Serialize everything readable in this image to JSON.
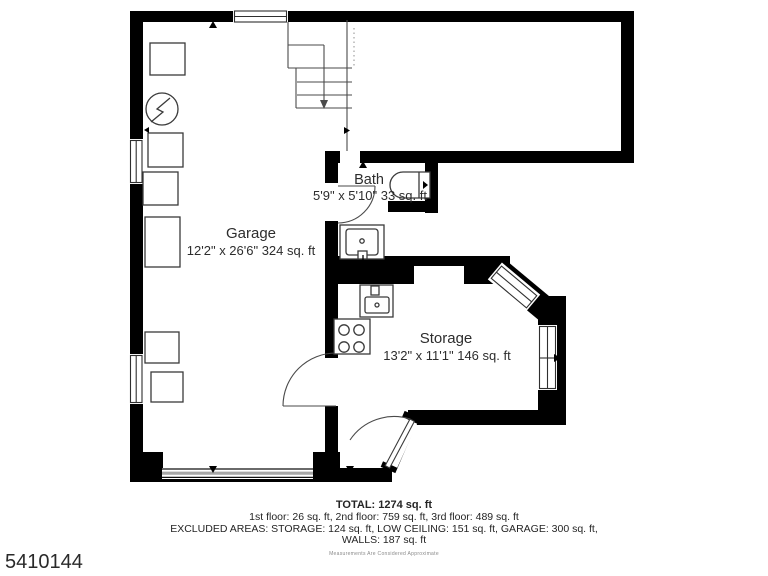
{
  "listing_id": "5410144",
  "rooms": {
    "garage": {
      "name": "Garage",
      "dims": "12'2\" x 26'6\" 324 sq. ft"
    },
    "bath": {
      "name": "Bath",
      "dims": "5'9\" x 5'10\" 33 sq. ft"
    },
    "storage": {
      "name": "Storage",
      "dims": "13'2\" x 11'1\" 146 sq. ft"
    }
  },
  "summary": {
    "total": "TOTAL: 1274 sq. ft",
    "floors": "1st floor: 26 sq. ft, 2nd floor: 759 sq. ft, 3rd floor: 489 sq. ft",
    "excluded_areas": "EXCLUDED AREAS: STORAGE: 124 sq. ft, LOW CEILING: 151 sq. ft, GARAGE: 300 sq. ft,",
    "walls": "WALLS: 187 sq. ft",
    "disclaimer": "Measurements Are Considered Approximate"
  },
  "colors": {
    "walls": "#000000",
    "text": "#2d2d2d",
    "garage_door": "#a6a6a6",
    "background": "#ffffff"
  }
}
